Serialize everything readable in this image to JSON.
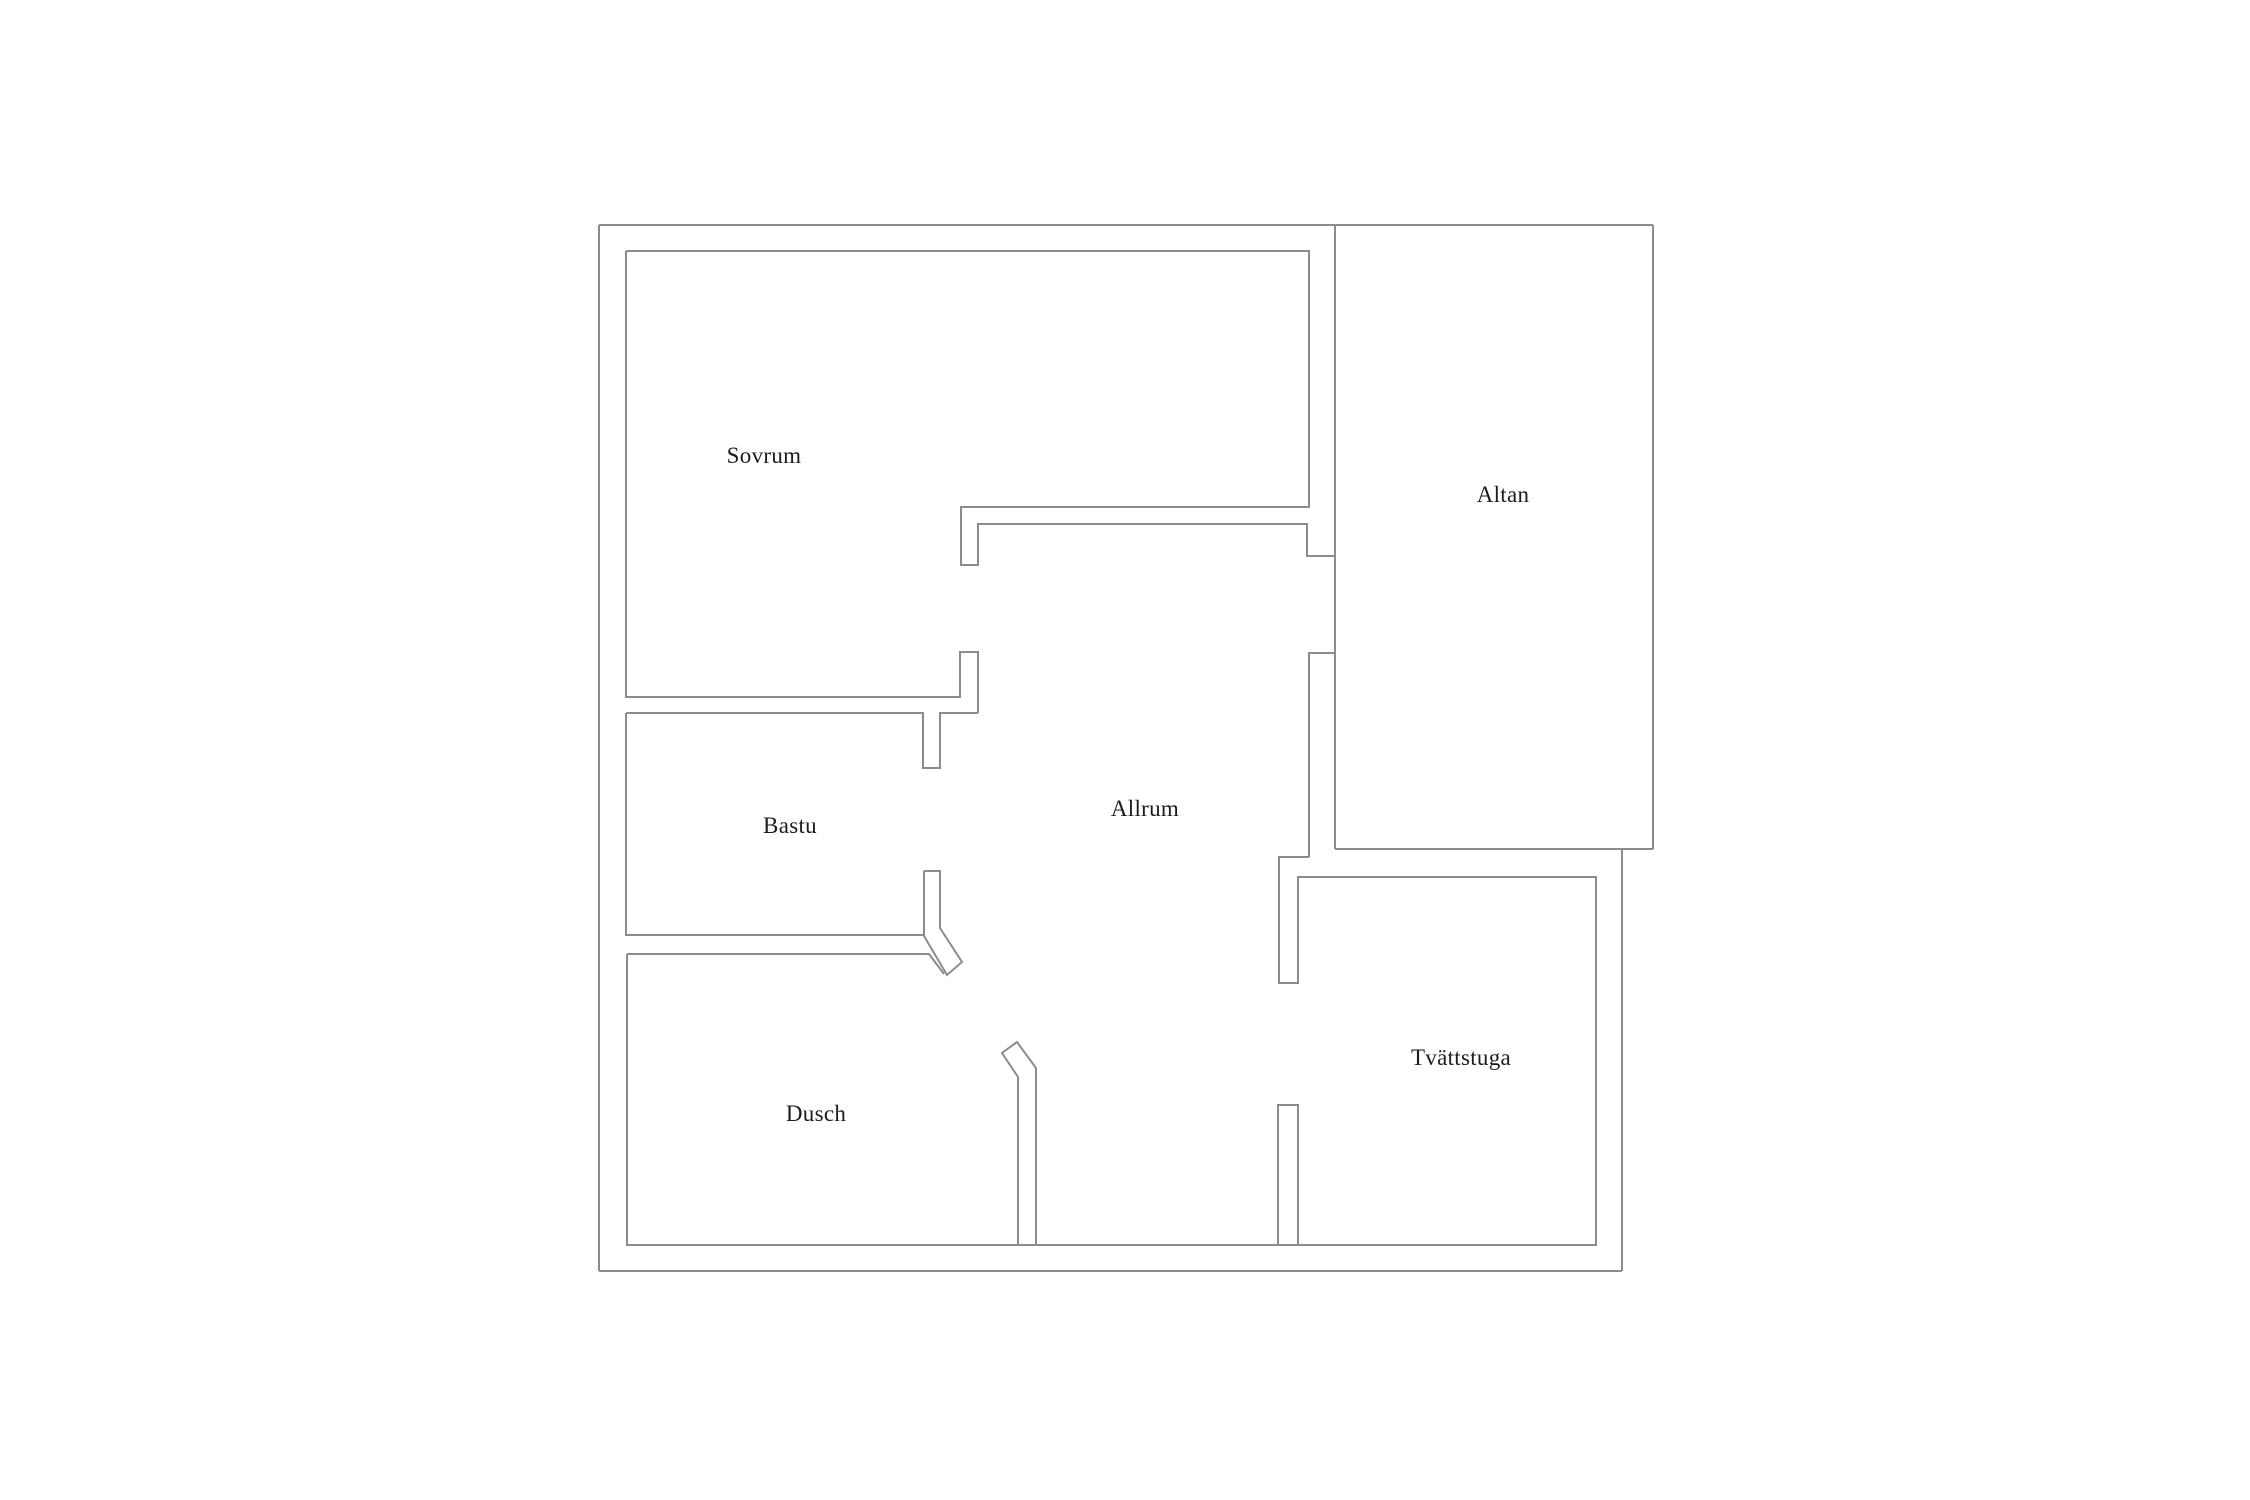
{
  "title": "Floor plan",
  "canvas": {
    "width": 2250,
    "height": 1500,
    "background": "#ffffff"
  },
  "plan": {
    "stroke_color": "#8c8c8c",
    "stroke_width": 2,
    "label_color": "#1c1c1c",
    "rooms": [
      {
        "id": "sovrum",
        "label": "Sovrum",
        "x": 764,
        "y": 456
      },
      {
        "id": "altan",
        "label": "Altan",
        "x": 1503,
        "y": 495
      },
      {
        "id": "bastu",
        "label": "Bastu",
        "x": 790,
        "y": 826
      },
      {
        "id": "allrum",
        "label": "Allrum",
        "x": 1145,
        "y": 809
      },
      {
        "id": "dusch",
        "label": "Dusch",
        "x": 816,
        "y": 1114
      },
      {
        "id": "tvattstuga",
        "label": "Tvättstuga",
        "x": 1461,
        "y": 1058
      }
    ],
    "walls": [
      {
        "name": "outer-top",
        "points": [
          [
            599,
            225
          ],
          [
            1653,
            225
          ]
        ]
      },
      {
        "name": "terrace-right",
        "points": [
          [
            1653,
            225
          ],
          [
            1653,
            849
          ]
        ]
      },
      {
        "name": "terrace-bottom",
        "points": [
          [
            1335,
            849
          ],
          [
            1653,
            849
          ]
        ]
      },
      {
        "name": "terrace-left",
        "points": [
          [
            1335,
            226
          ],
          [
            1335,
            849
          ]
        ]
      },
      {
        "name": "outer-right-lower",
        "points": [
          [
            1622,
            849
          ],
          [
            1622,
            1271
          ]
        ]
      },
      {
        "name": "outer-bottom",
        "points": [
          [
            599,
            1271
          ],
          [
            1622,
            1271
          ]
        ]
      },
      {
        "name": "outer-left",
        "points": [
          [
            599,
            225
          ],
          [
            599,
            1271
          ]
        ]
      },
      {
        "name": "sovrum-outline",
        "points": [
          [
            626,
            251
          ],
          [
            1309,
            251
          ],
          [
            1309,
            507
          ],
          [
            961,
            507
          ],
          [
            961,
            565
          ],
          [
            978,
            565
          ],
          [
            978,
            524
          ],
          [
            1307,
            524
          ],
          [
            1307,
            556
          ],
          [
            1335,
            556
          ]
        ]
      },
      {
        "name": "sovrum-left-bottom",
        "points": [
          [
            626,
            251
          ],
          [
            626,
            697
          ],
          [
            960,
            697
          ],
          [
            960,
            652
          ],
          [
            978,
            652
          ],
          [
            978,
            713
          ]
        ]
      },
      {
        "name": "bastu-top",
        "points": [
          [
            626,
            713
          ],
          [
            923,
            713
          ],
          [
            923,
            768
          ],
          [
            940,
            768
          ],
          [
            940,
            713
          ],
          [
            978,
            713
          ]
        ]
      },
      {
        "name": "bastu-left-bottom",
        "points": [
          [
            626,
            713
          ],
          [
            626,
            935
          ],
          [
            923,
            935
          ]
        ]
      },
      {
        "name": "bastu-door-leaf",
        "points": [
          [
            924,
            871
          ],
          [
            924,
            936
          ],
          [
            947,
            975
          ],
          [
            962,
            962
          ],
          [
            940,
            928
          ],
          [
            940,
            871
          ],
          [
            924,
            871
          ]
        ]
      },
      {
        "name": "dusch-top",
        "points": [
          [
            627,
            954
          ],
          [
            929,
            954
          ],
          [
            944,
            974
          ]
        ]
      },
      {
        "name": "dusch-outline",
        "points": [
          [
            627,
            954
          ],
          [
            627,
            1245
          ],
          [
            1018,
            1245
          ],
          [
            1018,
            1077
          ]
        ]
      },
      {
        "name": "dusch-door-leaf",
        "points": [
          [
            1018,
            1077
          ],
          [
            1002,
            1053
          ],
          [
            1017,
            1042
          ],
          [
            1036,
            1068
          ]
        ]
      },
      {
        "name": "entry-wall-left",
        "points": [
          [
            1036,
            1068
          ],
          [
            1036,
            1245
          ]
        ]
      },
      {
        "name": "bottom-inner-cap-left",
        "points": [
          [
            1018,
            1245
          ],
          [
            1036,
            1245
          ]
        ]
      },
      {
        "name": "entry-bottom",
        "points": [
          [
            1036,
            1245
          ],
          [
            1278,
            1245
          ]
        ]
      },
      {
        "name": "entry-wall-right",
        "points": [
          [
            1278,
            1245
          ],
          [
            1278,
            1105
          ],
          [
            1298,
            1105
          ],
          [
            1298,
            1245
          ]
        ]
      },
      {
        "name": "bottom-inner-cap-right",
        "points": [
          [
            1278,
            1245
          ],
          [
            1298,
            1245
          ]
        ]
      },
      {
        "name": "tvattstuga-outline",
        "points": [
          [
            1298,
            1245
          ],
          [
            1596,
            1245
          ],
          [
            1596,
            877
          ],
          [
            1298,
            877
          ],
          [
            1298,
            983
          ],
          [
            1279,
            983
          ],
          [
            1279,
            857
          ],
          [
            1309,
            857
          ]
        ]
      },
      {
        "name": "allrum-east-wall",
        "points": [
          [
            1309,
            857
          ],
          [
            1309,
            653
          ],
          [
            1336,
            653
          ]
        ]
      }
    ]
  }
}
